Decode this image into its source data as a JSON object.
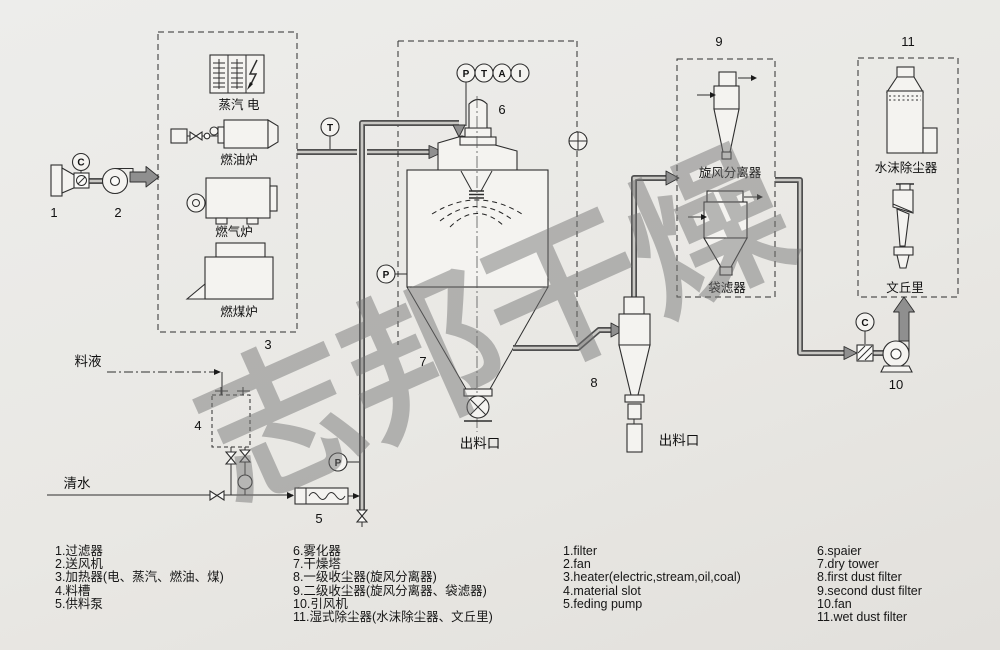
{
  "colors": {
    "background": "#e9e8e4",
    "line": "#2e2e2e",
    "pipe_casing": "#4f4f4f",
    "pipe_inner": "#c9c8c4",
    "flow_arrow": "#8f8f8f",
    "watermark": "rgba(115,115,115,0.48)"
  },
  "watermark": {
    "text": "志邦干燥"
  },
  "diagram": {
    "numbers": {
      "n1": "1",
      "n2": "2",
      "n3": "3",
      "n4": "4",
      "n5": "5",
      "n6": "6",
      "n7": "7",
      "n8": "8",
      "n9": "9",
      "n10": "10",
      "n11": "11"
    },
    "gauges": {
      "c_intake": "C",
      "t_duct": "T",
      "p_tower": "P",
      "p_feed": "P",
      "c_exhaust": "C",
      "ptai": [
        "P",
        "T",
        "A",
        "I"
      ]
    },
    "equipment": {
      "steam_electric": "蒸汽 电",
      "oil_furnace": "燃油炉",
      "gas_furnace": "燃气炉",
      "coal_furnace": "燃煤炉",
      "cyclone_separator": "旋风分离器",
      "bag_filter": "袋滤器",
      "water_mist_remover": "水沫除尘器",
      "venturi": "文丘里",
      "feed_liquid": "料液",
      "clean_water": "清水",
      "tower_outlet": "出料口",
      "cyclone_outlet": "出料口"
    }
  },
  "legend": {
    "col1": [
      "1.过滤器",
      "2.送风机",
      "3.加热器(电、蒸汽、燃油、煤)",
      "4.料槽",
      "5.供料泵"
    ],
    "col2": [
      "6.雾化器",
      "7.干燥塔",
      "8.一级收尘器(旋风分离器)",
      "9.二级收尘器(旋风分离器、袋滤器)",
      "10.引风机",
      "11.湿式除尘器(水沫除尘器、文丘里)"
    ],
    "col3": [
      "1.filter",
      "2.fan",
      "3.heater(electric,stream,oil,coal)",
      "4.material slot",
      "5.feding pump"
    ],
    "col4": [
      "6.spaier",
      "7.dry tower",
      "8.first dust filter",
      "9.second dust filter",
      "10.fan",
      "11.wet dust filter"
    ]
  }
}
